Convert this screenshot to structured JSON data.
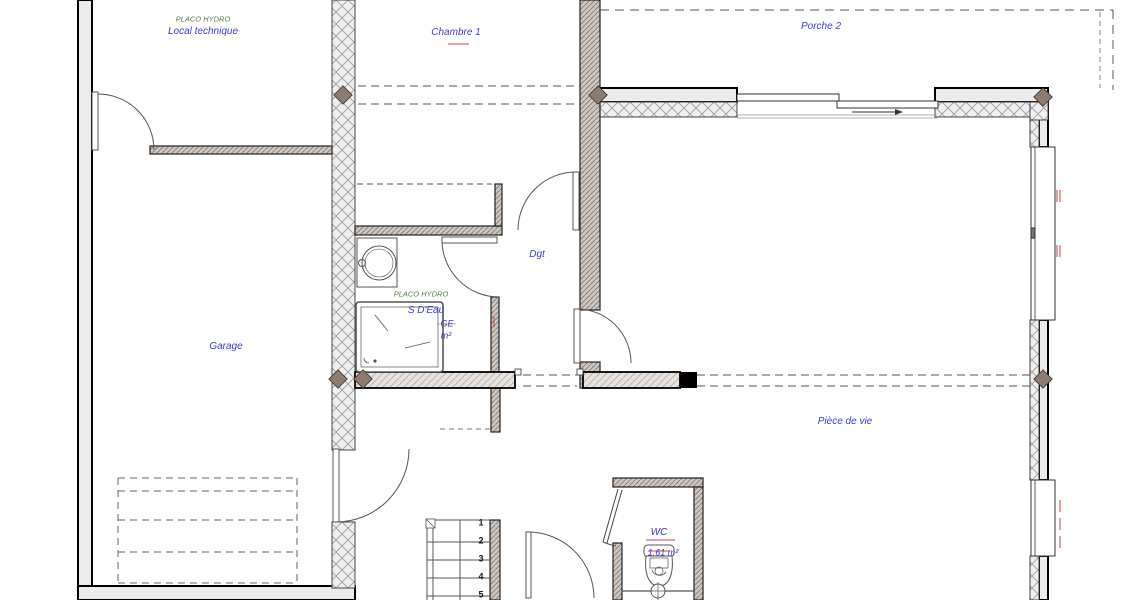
{
  "plan": {
    "rooms": {
      "local_technique": {
        "label": "Local technique"
      },
      "chambre1": {
        "label": "Chambre 1"
      },
      "porche2": {
        "label": "Porche 2"
      },
      "garage": {
        "label": "Garage"
      },
      "dgt": {
        "label": "Dgt"
      },
      "s_deau": {
        "label": "S D'Eau",
        "line2": "GE",
        "line3": "m²"
      },
      "piece_de_vie": {
        "label": "Pièce de vie"
      },
      "wc": {
        "label": "WC",
        "area": "1.61 m²"
      }
    },
    "annotations": {
      "green_top": "PLACO HYDRO",
      "green_sdeau": "PLACO HYDRO"
    },
    "stairs": {
      "treads": [
        "1",
        "2",
        "3",
        "4",
        "5"
      ]
    },
    "colors": {
      "label_blue": "#3b3bd6",
      "annotation_green": "#4a7f3c",
      "revision_red": "#cc4444",
      "wall_gray": "#ececec",
      "junction_brown": "#8d7b70"
    }
  }
}
